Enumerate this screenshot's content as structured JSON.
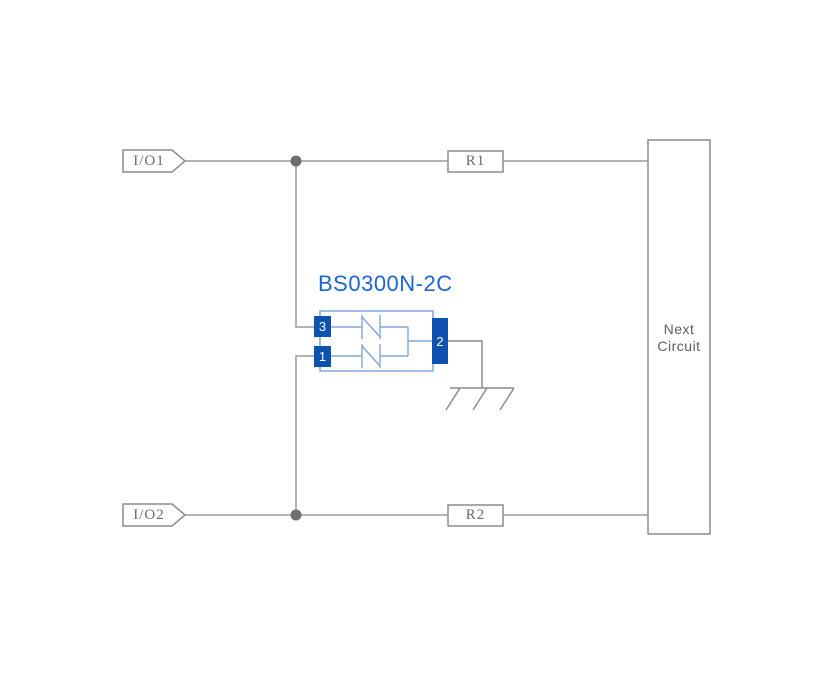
{
  "diagram": {
    "component": {
      "title": "BS0300N-2C",
      "pins": {
        "pin3": "3",
        "pin1": "1",
        "pin2": "2"
      }
    },
    "ports": {
      "io1": "I/O1",
      "io2": "I/O2"
    },
    "resistors": {
      "r1": "R1",
      "r2": "R2"
    },
    "next_circuit": {
      "line1": "Next",
      "line2": "Circuit"
    },
    "colors": {
      "wire_gray": "#9a9a9a",
      "outline_gray": "#8c8c8c",
      "label_gray": "#6b6b6b",
      "title_blue": "#1b66d5",
      "pin_blue": "#0d52ae",
      "component_outline_blue": "#7fa8d9",
      "junction_gray": "#6e6e6e",
      "background": "#ffffff"
    }
  }
}
